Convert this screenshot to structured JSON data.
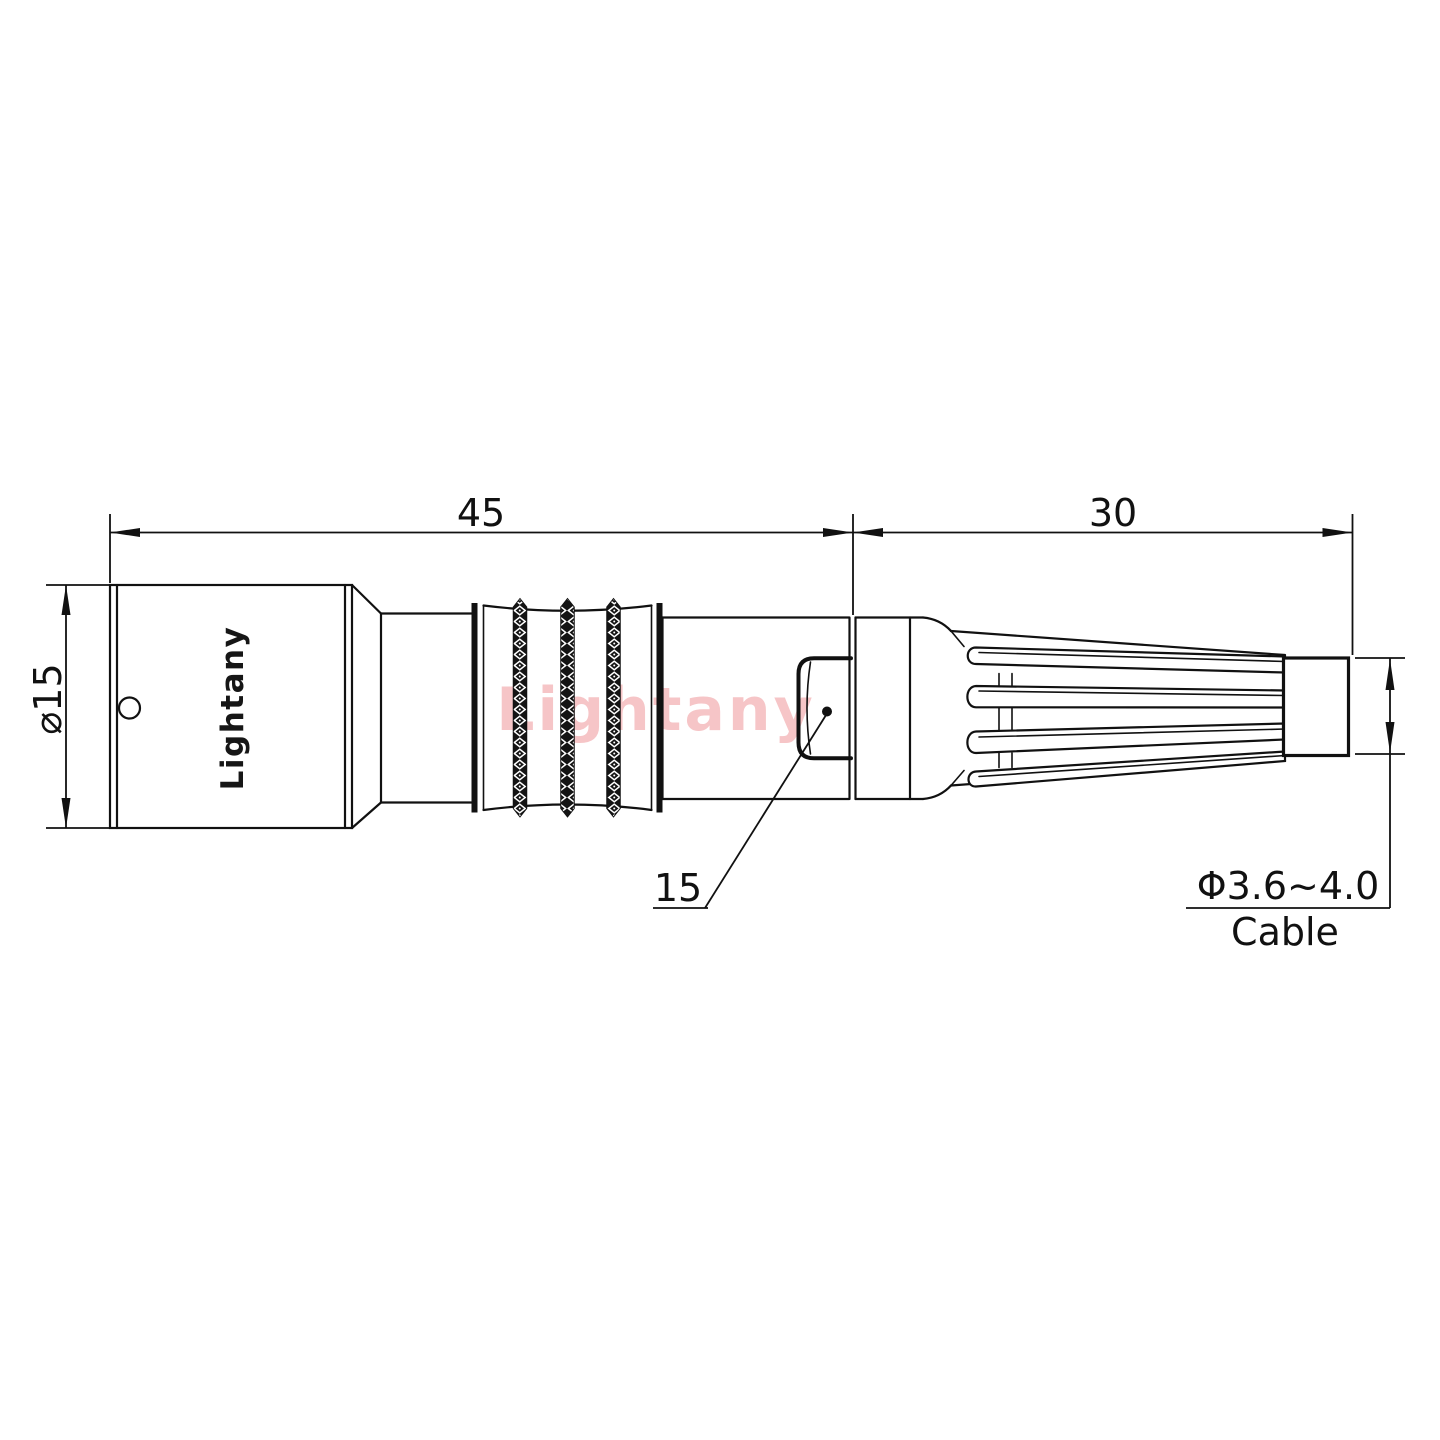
{
  "watermark": {
    "text": "Lightany"
  },
  "part": {
    "brand_label": "Lightany"
  },
  "dims": {
    "overall_length": "45",
    "rear_length": "30",
    "body_diameter": "⌀15",
    "cable_diameter": "Φ3.6~4.0",
    "cable_label": "Cable",
    "feature_callout": "15"
  },
  "colors": {
    "line": "#111111",
    "watermark": "#f6c5c7",
    "background": "#ffffff"
  }
}
